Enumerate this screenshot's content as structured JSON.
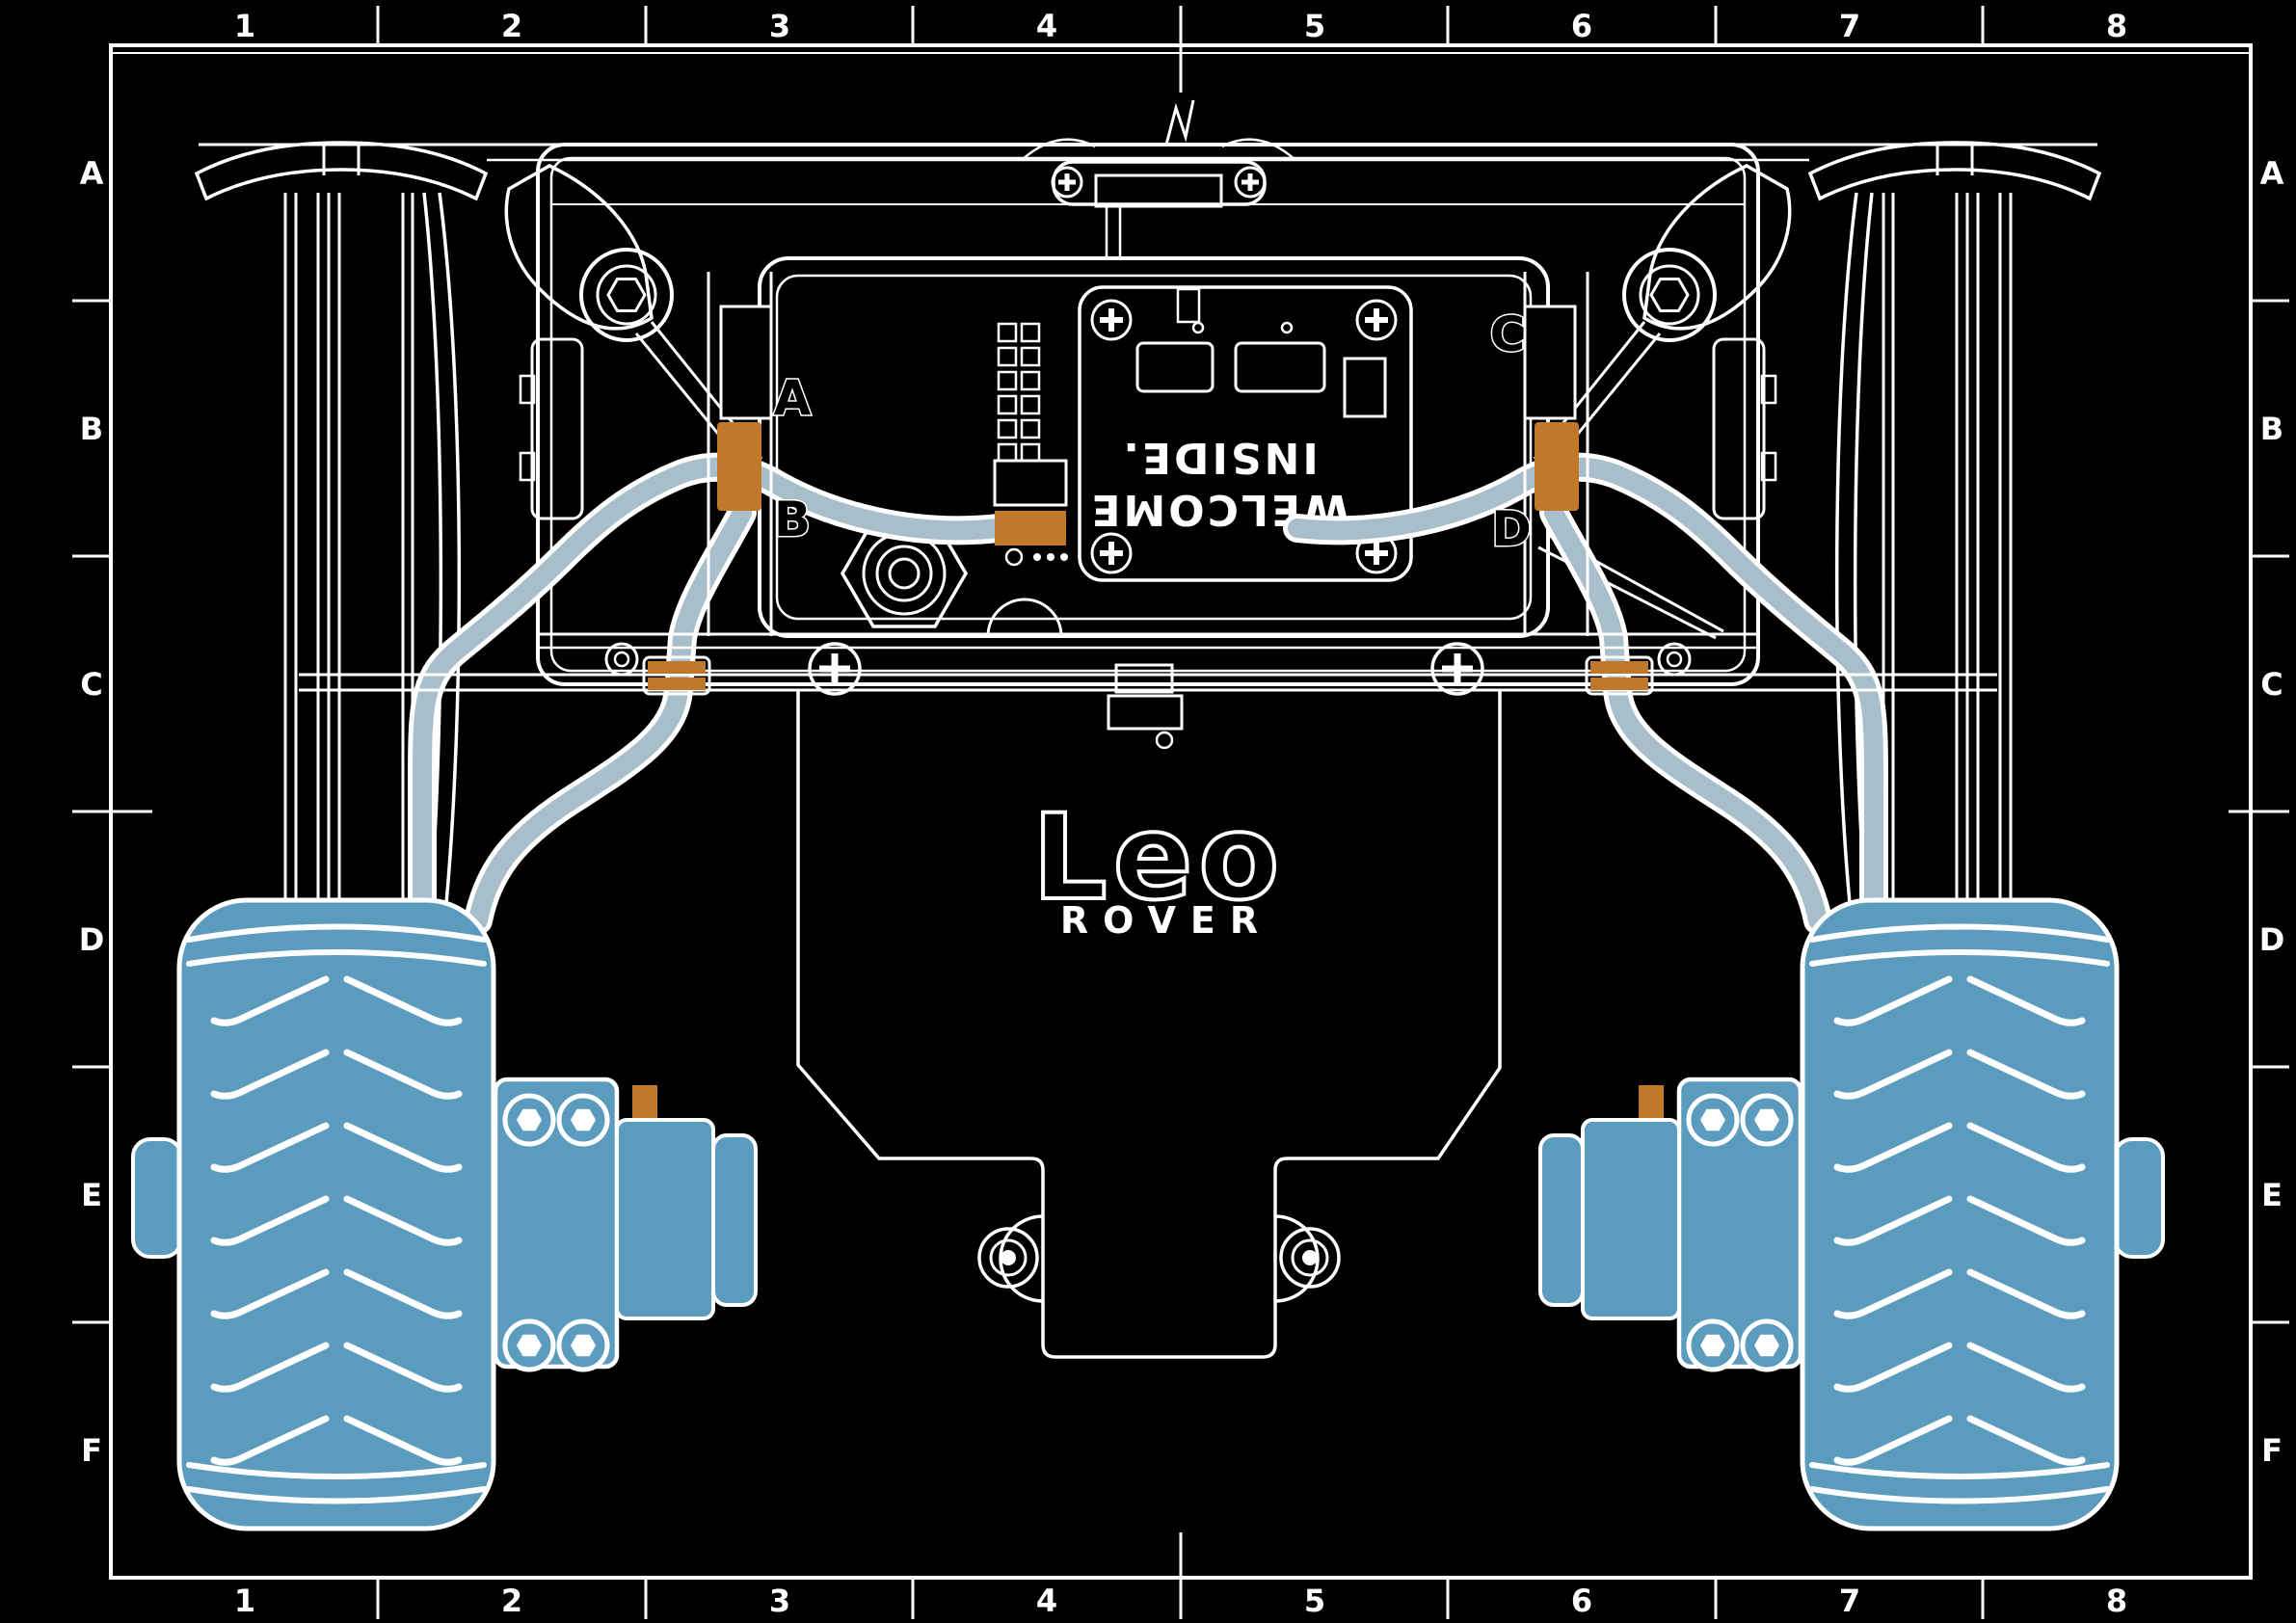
{
  "document": {
    "type": "assembly-drawing",
    "subject": "Leo Rover rear view blueprint"
  },
  "grid": {
    "cols": [
      "1",
      "2",
      "3",
      "4",
      "5",
      "6",
      "7",
      "8"
    ],
    "rows": [
      "A",
      "B",
      "C",
      "D",
      "E",
      "F"
    ]
  },
  "connectors": {
    "a": "A",
    "b": "B",
    "c": "C",
    "d": "D"
  },
  "board": {
    "line1": "WELCOME",
    "line2": "INSIDE."
  },
  "logo": {
    "main": "Leo",
    "sub": "ROVER"
  },
  "colors": {
    "background": "#000000",
    "ink": "#ffffff",
    "wheel_blue": "#5b9cbe",
    "cable_blue": "#a8bfcb",
    "connector_orange": "#c0792b"
  }
}
